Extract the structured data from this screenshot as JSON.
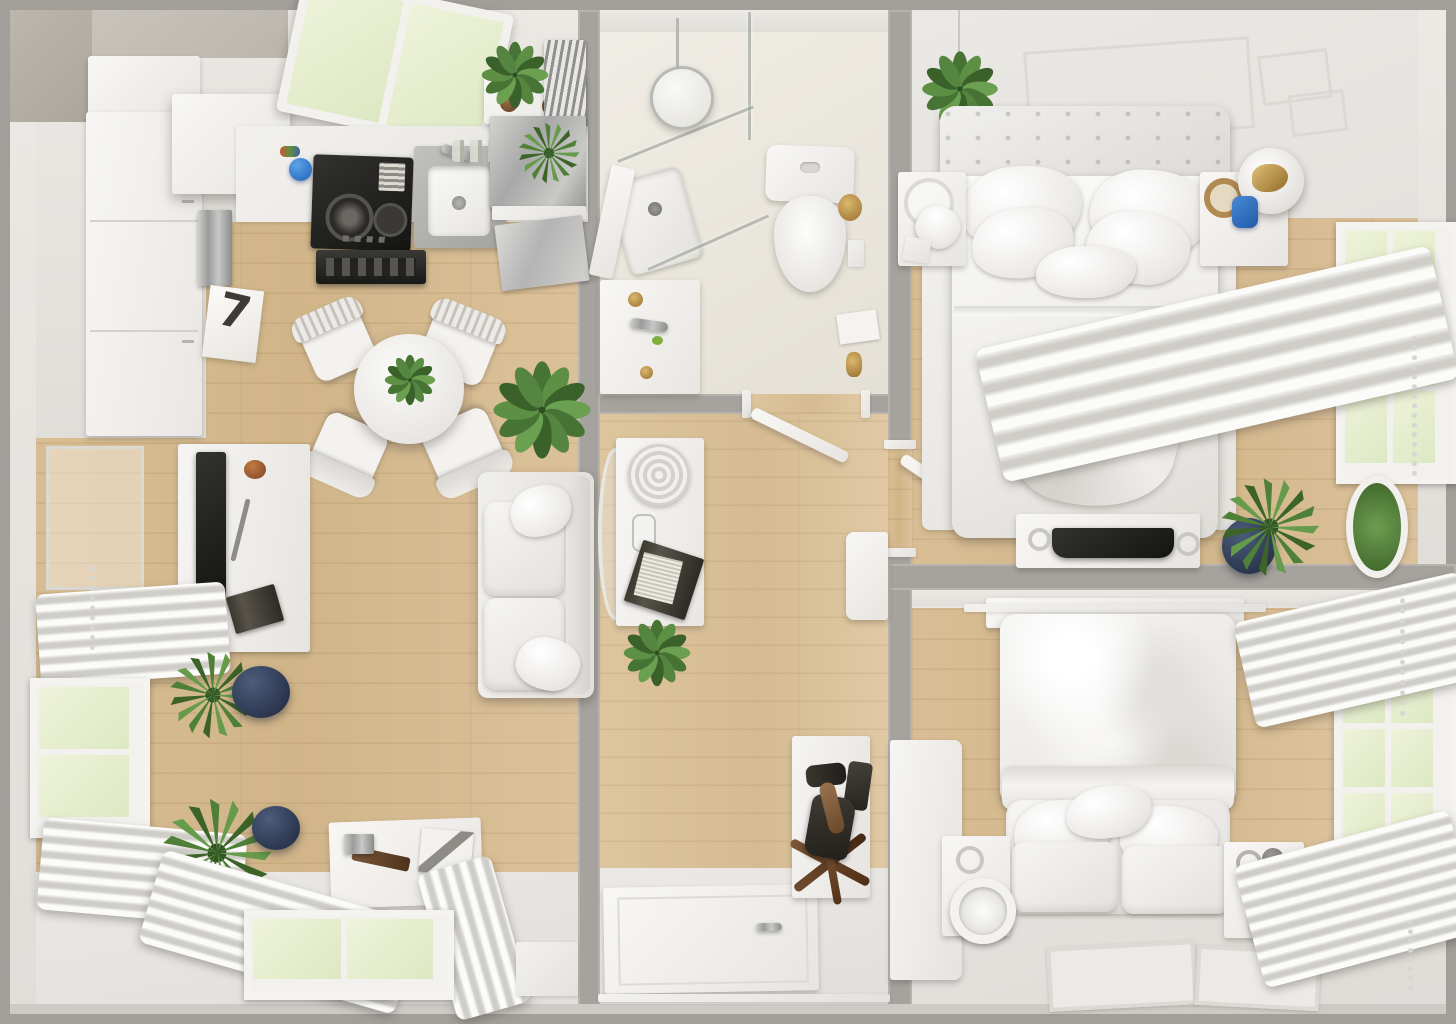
{
  "scene": {
    "title": "apartment-top-view-3d-floor-plan",
    "style": "white scandinavian interior with light oak floors",
    "view": "top-down render, no visible UI text"
  },
  "kitchen": {
    "artwork_glyph": "7"
  },
  "palette": {
    "outer_wall_gray": "#a6a29d",
    "wood_floor": "#d7bc93",
    "hall_wood_floor": "#dcc49d",
    "white_floor": "#e8e6e1",
    "bath_floor": "#ebe7de",
    "white_furniture": "#f2f1ee",
    "window_greenery": "#e6eecf",
    "plant_green": "#4e7c38",
    "navy_pot": "#33415c",
    "accent_blue": "#2b7fd4",
    "accent_gold": "#b08a4f",
    "appliance_black": "#222220"
  },
  "rooms": [
    {
      "name": "kitchen",
      "items": [
        "skylight-window",
        "wall-cabinets",
        "tall-cabinet",
        "gas-hob",
        "range-hood",
        "sink",
        "counter",
        "open-shelf",
        "steel-fridge",
        "dishwasher",
        "artwork-7",
        "blue-ball",
        "utensil-rack"
      ]
    },
    {
      "name": "living-dining",
      "items": [
        "round-dining-table",
        "dining-chairs-x4",
        "table-centerpiece",
        "large-potted-plant",
        "sofa",
        "tv-console",
        "tv",
        "wall-frame",
        "left-window",
        "pleated-curtains",
        "navy-potted-plants-x2",
        "work-desk",
        "bottom-window",
        "curtain-piles"
      ]
    },
    {
      "name": "bathroom",
      "items": [
        "corner-shower",
        "glass-screen",
        "shower-tray",
        "pendant-glass-lamp",
        "toilet",
        "vanity-sink",
        "gold-fittings",
        "door-leaf"
      ]
    },
    {
      "name": "hallway",
      "items": [
        "console-table",
        "rope-basket",
        "carafe",
        "book-stack",
        "oval-wall-mirror",
        "potted-plant",
        "door-to-bathroom",
        "door-to-bedroom",
        "wall-cabinet"
      ]
    },
    {
      "name": "entrance",
      "items": [
        "front-door",
        "star-coat-stand",
        "boots",
        "shoe-panel",
        "wall-hooks"
      ]
    },
    {
      "name": "bedroom-1",
      "items": [
        "double-bed",
        "tufted-headboard",
        "pillows-x5",
        "throw-blanket",
        "white-rug",
        "nightstand-left",
        "nightstand-right",
        "disc-table-lamp",
        "hanging-plant",
        "tv-dresser",
        "right-window",
        "roman-curtain",
        "navy-pot-plant",
        "wall-wreath",
        "ceiling-panels"
      ]
    },
    {
      "name": "bedroom-2",
      "items": [
        "double-bed",
        "crumpled-duvet",
        "headboard-panel",
        "wardrobe",
        "nightstand-ring-lamps-x2",
        "pillow-bench",
        "floor-mats-x2",
        "right-window",
        "pleated-curtains-x2"
      ]
    }
  ]
}
